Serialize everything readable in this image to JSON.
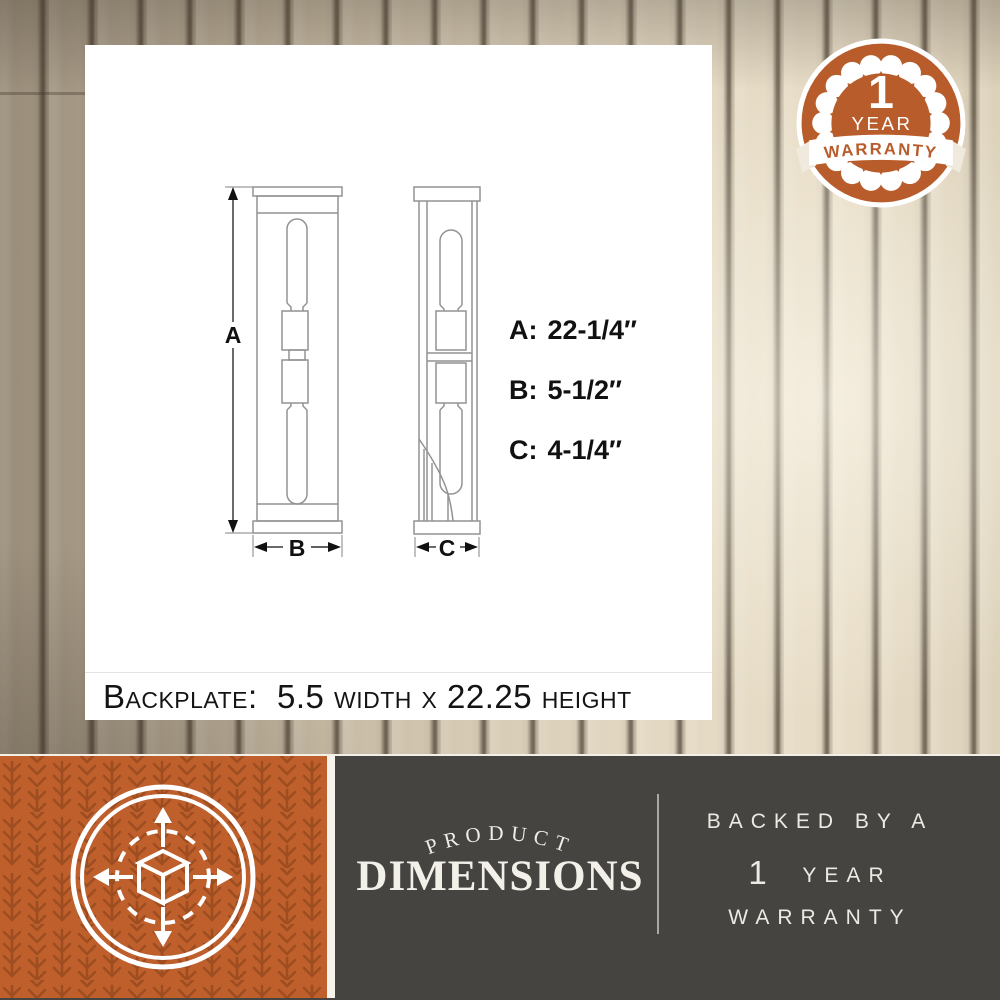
{
  "colors": {
    "accent_orange": "#B85C2B",
    "pattern_orange": "#9D4D20",
    "charcoal": "#454441",
    "wood_light": "#E3D8C2",
    "wood_dark": "#998C79"
  },
  "icons": {
    "badge": "warranty-seal-icon",
    "footer_square": "3d-dimensions-cube-icon"
  },
  "warranty_badge": {
    "number": "1",
    "year": "YEAR",
    "warranty": "WARRANTY"
  },
  "diagram": {
    "marker_a": "A",
    "marker_b": "B",
    "marker_c": "C",
    "dimensions": [
      {
        "label": "A:",
        "value": "22-1/4″"
      },
      {
        "label": "B:",
        "value": "5-1/2″"
      },
      {
        "label": "C:",
        "value": "4-1/4″"
      }
    ],
    "backplate_note": "Backplate:  5.5 width x 22.25 height"
  },
  "footer": {
    "arc_label": "PRODUCT",
    "title": "DIMENSIONS",
    "backed_line": "BACKED BY A",
    "year_number": "1",
    "year_word": "YEAR",
    "warranty_word": "WARRANTY"
  }
}
